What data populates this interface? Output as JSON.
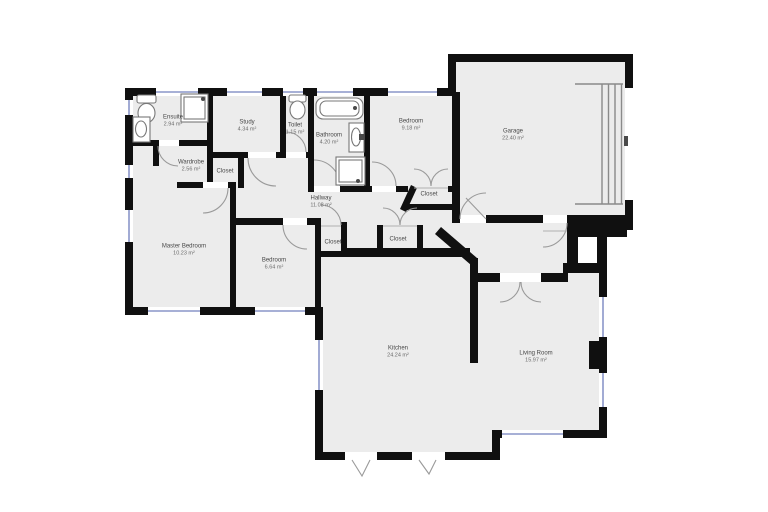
{
  "plan": {
    "background_color": "#ffffff",
    "floor_color": "#ececec",
    "wall_color": "#101010",
    "window_color": "#8a96c9",
    "door_arc_color": "#9a9a9a",
    "label_color": "#555555",
    "area_unit": "m²"
  },
  "fixture_icons": [
    "toilet-icon",
    "sink-icon",
    "shower-icon",
    "bathtub-icon",
    "garage-door-icon"
  ],
  "rooms": [
    {
      "name": "Ensuite",
      "area": "2.94 m²"
    },
    {
      "name": "Study",
      "area": "4.34 m²"
    },
    {
      "name": "Toilet",
      "area": "1.15 m²"
    },
    {
      "name": "Bathroom",
      "area": "4.20 m²"
    },
    {
      "name": "Bedroom",
      "area": "9.18 m²"
    },
    {
      "name": "Garage",
      "area": "22.40 m²"
    },
    {
      "name": "Wardrobe",
      "area": "2.56 m²"
    },
    {
      "name": "Closet",
      "area": ""
    },
    {
      "name": "Hallway",
      "area": "11.08 m²"
    },
    {
      "name": "Closet",
      "area": ""
    },
    {
      "name": "Closet",
      "area": ""
    },
    {
      "name": "Closet",
      "area": ""
    },
    {
      "name": "Master Bedroom",
      "area": "10.23 m²"
    },
    {
      "name": "Bedroom",
      "area": "6.64 m²"
    },
    {
      "name": "Kitchen",
      "area": "24.24 m²"
    },
    {
      "name": "Living Room",
      "area": "15.97 m²"
    }
  ]
}
